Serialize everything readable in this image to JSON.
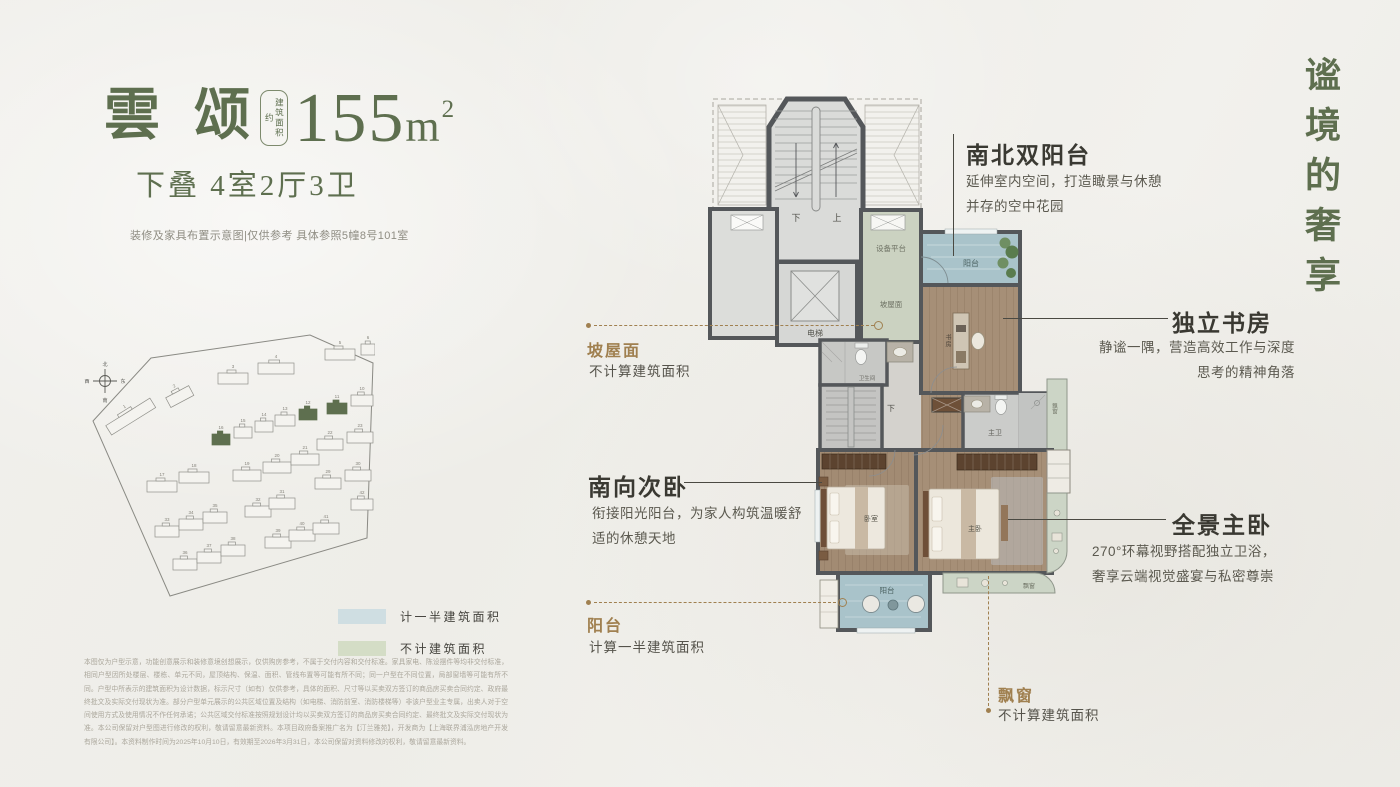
{
  "header": {
    "name": "雲 颂",
    "area_box": "建筑面积约",
    "area_number": "155",
    "area_unit": "m",
    "area_sup": "2",
    "subtitle": "下叠  4室2厅3卫",
    "note": "装修及家具布置示意图|仅供参考 具体参照5幢8号101室"
  },
  "tagline": "谧境的奢享",
  "legend": [
    {
      "label": "计一半建筑面积",
      "color": "#cfdee2"
    },
    {
      "label": "不计建筑面积",
      "color": "#d4ddc6"
    }
  ],
  "disclaimer": "本图仅为户型示意，功能创意展示和装修意境创想展示，仅供购房参考，不属于交付内容和交付标准。家具家电、陈设摆件等均非交付标准，相同户型因所处楼层、楼栋、单元不同，屋顶结构、保温、面积、管线布置等可能有所不同；同一户型在不同位置，局部窗墙等可能有所不同。户型中所表示的建筑面积为设计数据，标示尺寸（如有）仅供参考，具体的面积、尺寸等以买卖双方签订的商品房买卖合同约定、政府最终批文及实际交付现状为准。部分户型单元展示的公共区域位置及结构（如电梯、消防前室、消防楼梯等）非该户型业主专属，出卖人对于空间使用方式及使用情况不作任何承诺；公共区域交付标准按照规划设计均以买卖双方签订的商品房买卖合同约定、最终批文及实际交付现状为准。本公司保留对户型图进行修改的权利，敬请留意最新资料。本项目政府备案推广名为【汀兰雅苑】，开发商为【上海联界浦泓房地产开发有限公司】。本资料制作时间为2025年10月10日，有效期至2026年3月31日，本公司保留对资料修改的权利，敬请留意最新资料。",
  "callouts": {
    "north_south_balcony": {
      "title": "南北双阳台",
      "lines": [
        "延伸室内空间，打造瞰景与休憩",
        "并存的空中花园"
      ]
    },
    "study": {
      "title": "独立书房",
      "lines": [
        "静谧一隅，营造高效工作与深度",
        "思考的精神角落"
      ]
    },
    "south_bedroom": {
      "title": "南向次卧",
      "lines": [
        "衔接阳光阳台，为家人构筑温暖舒",
        "适的休憩天地"
      ]
    },
    "master_bedroom": {
      "title": "全景主卧",
      "lines": [
        "270°环幕视野搭配独立卫浴，",
        "奢享云端视觉盛宴与私密尊崇"
      ]
    },
    "slope_roof": {
      "title": "坡屋面",
      "desc": "不计算建筑面积"
    },
    "half_balcony": {
      "title": "阳台",
      "desc": "计算一半建筑面积"
    },
    "bay_window": {
      "title": "飘窗",
      "desc": "不计算建筑面积"
    }
  },
  "plan": {
    "stair_down": "下",
    "stair_up": "上",
    "stair_down2": "下",
    "elevator": "电梯",
    "equipment_platform": "设备平台",
    "slope_roof": "坡屋面",
    "balcony_top": "阳台",
    "study": "书房",
    "bathroom": "卫生间",
    "master_bath": "主卫",
    "bay1": "飘窗",
    "bedroom": "卧室",
    "master_bedroom": "主卧",
    "balcony_bottom": "阳台",
    "bay2": "飘窗"
  },
  "site_plan": {
    "compass": [
      "北",
      "南",
      "西",
      "东"
    ],
    "highlight_color": "#5e6f4f",
    "buildings": [
      {
        "x": 30,
        "y": 78,
        "w": 52,
        "n": "1",
        "r": -32
      },
      {
        "x": 92,
        "y": 58,
        "w": 26,
        "n": "2",
        "r": -28
      },
      {
        "x": 143,
        "y": 40,
        "w": 30,
        "n": "3"
      },
      {
        "x": 183,
        "y": 30,
        "w": 36,
        "n": "4"
      },
      {
        "x": 250,
        "y": 16,
        "w": 30,
        "n": "5"
      },
      {
        "x": 286,
        "y": 11,
        "w": 14,
        "n": "6"
      },
      {
        "x": 276,
        "y": 62,
        "w": 22,
        "n": "10"
      },
      {
        "x": 252,
        "y": 70,
        "w": 20,
        "n": "11",
        "h": 1
      },
      {
        "x": 224,
        "y": 76,
        "w": 18,
        "n": "12",
        "h": 1
      },
      {
        "x": 200,
        "y": 82,
        "w": 20,
        "n": "13"
      },
      {
        "x": 180,
        "y": 88,
        "w": 18,
        "n": "14"
      },
      {
        "x": 159,
        "y": 94,
        "w": 18,
        "n": "15"
      },
      {
        "x": 137,
        "y": 101,
        "w": 18,
        "n": "16",
        "h": 1
      },
      {
        "x": 242,
        "y": 106,
        "w": 26,
        "n": "22"
      },
      {
        "x": 272,
        "y": 99,
        "w": 26,
        "n": "23"
      },
      {
        "x": 72,
        "y": 148,
        "w": 30,
        "n": "17"
      },
      {
        "x": 104,
        "y": 139,
        "w": 30,
        "n": "18"
      },
      {
        "x": 158,
        "y": 137,
        "w": 28,
        "n": "19"
      },
      {
        "x": 188,
        "y": 129,
        "w": 28,
        "n": "20"
      },
      {
        "x": 216,
        "y": 121,
        "w": 28,
        "n": "21"
      },
      {
        "x": 240,
        "y": 145,
        "w": 26,
        "n": "29"
      },
      {
        "x": 270,
        "y": 137,
        "w": 26,
        "n": "30"
      },
      {
        "x": 80,
        "y": 193,
        "w": 24,
        "n": "33"
      },
      {
        "x": 104,
        "y": 186,
        "w": 24,
        "n": "34"
      },
      {
        "x": 128,
        "y": 179,
        "w": 24,
        "n": "35"
      },
      {
        "x": 170,
        "y": 173,
        "w": 26,
        "n": "32"
      },
      {
        "x": 194,
        "y": 165,
        "w": 26,
        "n": "31"
      },
      {
        "x": 276,
        "y": 166,
        "w": 22,
        "n": "42"
      },
      {
        "x": 98,
        "y": 226,
        "w": 24,
        "n": "36"
      },
      {
        "x": 122,
        "y": 219,
        "w": 24,
        "n": "37"
      },
      {
        "x": 146,
        "y": 212,
        "w": 24,
        "n": "38"
      },
      {
        "x": 190,
        "y": 204,
        "w": 26,
        "n": "39"
      },
      {
        "x": 214,
        "y": 197,
        "w": 26,
        "n": "40"
      },
      {
        "x": 238,
        "y": 190,
        "w": 26,
        "n": "41"
      }
    ]
  }
}
